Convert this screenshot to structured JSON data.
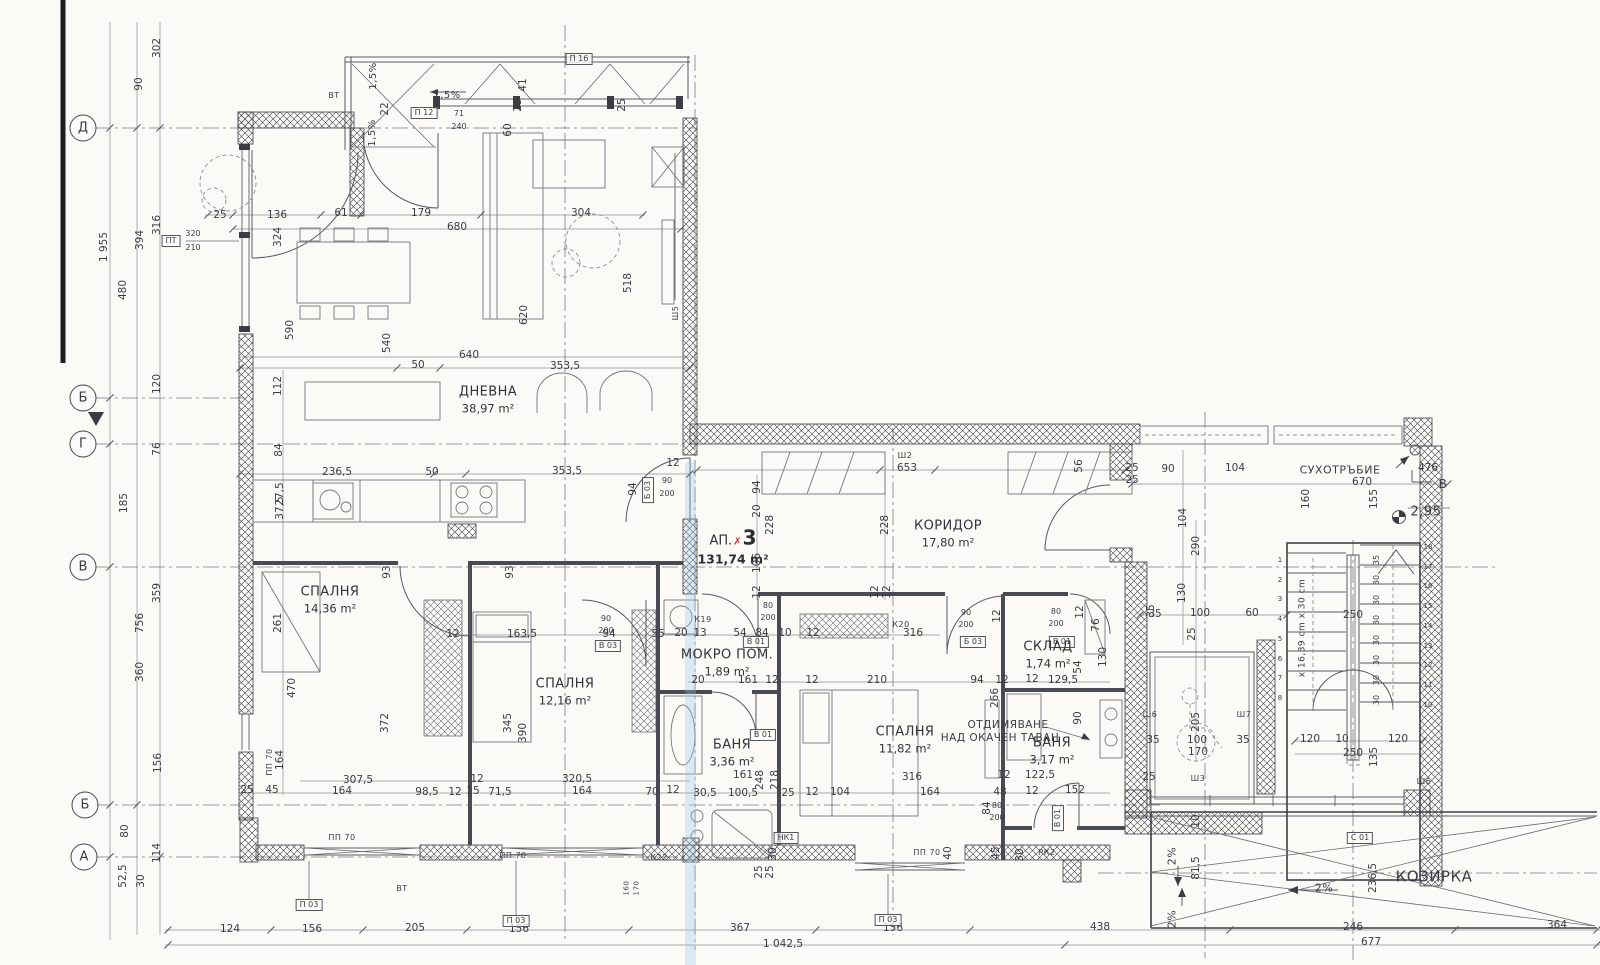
{
  "plan": {
    "apartment_label": "АП.",
    "apartment_mark": "✗",
    "apartment_number": "3",
    "apartment_area": "131,74 m²"
  },
  "rooms": [
    {
      "n": "ДНЕВНА",
      "a": "38,97 m²",
      "x": 488,
      "y": 400
    },
    {
      "n": "КОРИДОР",
      "a": "17,80 m²",
      "x": 948,
      "y": 534
    },
    {
      "n": "СПАЛНЯ",
      "a": "14,36 m²",
      "x": 330,
      "y": 600
    },
    {
      "n": "СПАЛНЯ",
      "a": "12,16 m²",
      "x": 565,
      "y": 692
    },
    {
      "n": "СПАЛНЯ",
      "a": "11,82 m²",
      "x": 905,
      "y": 740
    },
    {
      "n": "МОКРО ПОМ.",
      "a": "1,89 m²",
      "x": 727,
      "y": 663
    },
    {
      "n": "БАНЯ",
      "a": "3,36 m²",
      "x": 732,
      "y": 753
    },
    {
      "n": "БАНЯ",
      "a": "3,17 m²",
      "x": 1052,
      "y": 751
    },
    {
      "n": "СКЛАД",
      "a": "1,74 m²",
      "x": 1048,
      "y": 655
    }
  ],
  "grid_markers": [
    {
      "l": "Д",
      "x": 83,
      "y": 128
    },
    {
      "l": "Б",
      "x": 83,
      "y": 398
    },
    {
      "l": "Г",
      "x": 83,
      "y": 444
    },
    {
      "l": "В",
      "x": 83,
      "y": 567
    },
    {
      "l": "Б",
      "x": 85,
      "y": 805
    },
    {
      "l": "А",
      "x": 84,
      "y": 857
    }
  ],
  "annotations": [
    {
      "t": "СУХОТРЪБИЕ",
      "x": 1340,
      "y": 470,
      "s": 11
    },
    {
      "t": "ОТДИМЯВАНЕ",
      "x": 1008,
      "y": 725,
      "s": 10.5
    },
    {
      "t": "НАД ОКАЧЕН ТАВАН",
      "x": 1000,
      "y": 738,
      "s": 10.5
    },
    {
      "t": "КОЗИРКА",
      "x": 1434,
      "y": 877,
      "s": 15
    },
    {
      "t": "2,95",
      "x": 1426,
      "y": 512,
      "s": 13
    },
    {
      "t": "В",
      "x": 1443,
      "y": 484,
      "s": 12
    },
    {
      "t": "1,5%",
      "x": 447,
      "y": 96,
      "s": 10
    },
    {
      "t": "1,5%",
      "x": 374,
      "y": 76,
      "s": 10,
      "r": 1
    },
    {
      "t": "1,5%",
      "x": 373,
      "y": 133,
      "s": 10,
      "r": 1
    },
    {
      "t": "2%",
      "x": 1324,
      "y": 888,
      "s": 11
    },
    {
      "t": "2%",
      "x": 1172,
      "y": 856,
      "s": 11,
      "r": 1
    },
    {
      "t": "2%",
      "x": 1172,
      "y": 919,
      "s": 11,
      "r": 1
    },
    {
      "t": "ВТ",
      "x": 334,
      "y": 96,
      "s": 8
    },
    {
      "t": "ВТ",
      "x": 402,
      "y": 889,
      "s": 8
    },
    {
      "t": "РК2",
      "x": 1047,
      "y": 853,
      "s": 8
    },
    {
      "t": "К19",
      "x": 703,
      "y": 620,
      "s": 8
    },
    {
      "t": "К20",
      "x": 901,
      "y": 625,
      "s": 8
    },
    {
      "t": "К22",
      "x": 659,
      "y": 858,
      "s": 8
    },
    {
      "t": "Ш2",
      "x": 905,
      "y": 456,
      "s": 8
    },
    {
      "t": "Ш5",
      "x": 676,
      "y": 313,
      "s": 8,
      "r": 1
    },
    {
      "t": "Ш6",
      "x": 1150,
      "y": 715,
      "s": 8
    },
    {
      "t": "Ш7",
      "x": 1244,
      "y": 715,
      "s": 8
    },
    {
      "t": "Ш3",
      "x": 1198,
      "y": 779,
      "s": 8
    },
    {
      "t": "Ш6",
      "x": 1424,
      "y": 782,
      "s": 8
    },
    {
      "t": "ПП 70",
      "x": 342,
      "y": 838,
      "s": 8
    },
    {
      "t": "ПП 70",
      "x": 513,
      "y": 856,
      "s": 8
    },
    {
      "t": "ПП 70",
      "x": 927,
      "y": 853,
      "s": 8
    },
    {
      "t": "ПП 70",
      "x": 270,
      "y": 762,
      "s": 8,
      "r": 1
    },
    {
      "t": "х 16,39 cm х 30 cm",
      "x": 1303,
      "y": 628,
      "s": 9,
      "r": 1
    },
    {
      "t": "160",
      "x": 627,
      "y": 888,
      "s": 7,
      "r": 1
    },
    {
      "t": "170",
      "x": 637,
      "y": 888,
      "s": 7,
      "r": 1
    }
  ],
  "tags": [
    {
      "t": "П 16",
      "x": 579,
      "y": 59
    },
    {
      "t": "П 12",
      "x": 424,
      "y": 113
    },
    {
      "t": "ПТ",
      "x": 171,
      "y": 241
    },
    {
      "t": "П 03",
      "x": 309,
      "y": 905
    },
    {
      "t": "П 03",
      "x": 516,
      "y": 921
    },
    {
      "t": "П 03",
      "x": 888,
      "y": 920
    },
    {
      "t": "С 01",
      "x": 1360,
      "y": 838
    },
    {
      "t": "В 03",
      "x": 608,
      "y": 646
    },
    {
      "t": "В 01",
      "x": 756,
      "y": 642
    },
    {
      "t": "Б 03",
      "x": 973,
      "y": 642
    },
    {
      "t": "В 01",
      "x": 1062,
      "y": 642
    },
    {
      "t": "В 01",
      "x": 763,
      "y": 735
    },
    {
      "t": "В 01",
      "x": 1058,
      "y": 818,
      "r": 1
    },
    {
      "t": "Б 03",
      "x": 648,
      "y": 490,
      "r": 1
    },
    {
      "t": "НК1",
      "x": 786,
      "y": 838
    }
  ],
  "dimensions": [
    [
      "302",
      157,
      48,
      1
    ],
    [
      "90",
      139,
      84,
      1
    ],
    [
      "1 955",
      104,
      247,
      1
    ],
    [
      "394",
      140,
      240,
      1
    ],
    [
      "316",
      157,
      225,
      1
    ],
    [
      "480",
      123,
      290,
      1
    ],
    [
      "120",
      157,
      384,
      1
    ],
    [
      "76",
      157,
      449,
      1
    ],
    [
      "185",
      124,
      503,
      1
    ],
    [
      "359",
      157,
      593,
      1
    ],
    [
      "756",
      140,
      623,
      1
    ],
    [
      "360",
      140,
      672,
      1
    ],
    [
      "156",
      158,
      763,
      1
    ],
    [
      "80",
      125,
      831,
      1
    ],
    [
      "114",
      157,
      853,
      1
    ],
    [
      "52,5",
      123,
      876,
      1
    ],
    [
      "30",
      141,
      881,
      1
    ],
    [
      "112",
      278,
      386,
      1
    ],
    [
      "84",
      279,
      450,
      1
    ],
    [
      "27,5",
      280,
      494,
      1
    ],
    [
      "37,5",
      280,
      508,
      1
    ],
    [
      "261",
      278,
      623,
      1
    ],
    [
      "164",
      280,
      760,
      1
    ],
    [
      "470",
      292,
      688,
      1
    ],
    [
      "372",
      385,
      723,
      1
    ],
    [
      "345",
      508,
      723,
      1
    ],
    [
      "390",
      523,
      733,
      1
    ],
    [
      "25",
      220,
      215
    ],
    [
      "136",
      277,
      215
    ],
    [
      "61",
      341,
      213
    ],
    [
      "179",
      421,
      213
    ],
    [
      "304",
      581,
      213
    ],
    [
      "680",
      457,
      227
    ],
    [
      "324",
      278,
      237,
      1
    ],
    [
      "590",
      290,
      330,
      1
    ],
    [
      "540",
      387,
      343,
      1
    ],
    [
      "518",
      628,
      283,
      1
    ],
    [
      "620",
      524,
      315,
      1
    ],
    [
      "41",
      523,
      85,
      1
    ],
    [
      "25",
      518,
      105,
      1
    ],
    [
      "22",
      385,
      109,
      1
    ],
    [
      "60",
      508,
      130,
      1
    ],
    [
      "25",
      622,
      105,
      1
    ],
    [
      "71",
      459,
      114,
      0,
      1
    ],
    [
      "240",
      459,
      127,
      0,
      1
    ],
    [
      "320",
      193,
      234,
      0,
      1
    ],
    [
      "210",
      193,
      248,
      0,
      1
    ],
    [
      "640",
      469,
      355
    ],
    [
      "50",
      418,
      365
    ],
    [
      "353,5",
      565,
      366
    ],
    [
      "236,5",
      337,
      472
    ],
    [
      "50",
      432,
      472
    ],
    [
      "353,5",
      567,
      471
    ],
    [
      "12",
      673,
      463
    ],
    [
      "94",
      633,
      489,
      1
    ],
    [
      "90",
      667,
      481,
      0,
      1
    ],
    [
      "200",
      667,
      494,
      0,
      1
    ],
    [
      "93",
      387,
      572,
      1
    ],
    [
      "93",
      510,
      572,
      1
    ],
    [
      "12",
      453,
      634
    ],
    [
      "163,5",
      522,
      634
    ],
    [
      "94",
      609,
      634
    ],
    [
      "55",
      658,
      634
    ],
    [
      "20",
      681,
      633
    ],
    [
      "13",
      700,
      633
    ],
    [
      "54",
      740,
      633
    ],
    [
      "84",
      762,
      633
    ],
    [
      "10",
      785,
      633
    ],
    [
      "12",
      813,
      633
    ],
    [
      "316",
      913,
      633
    ],
    [
      "90",
      606,
      619,
      0,
      1
    ],
    [
      "200",
      606,
      631,
      0,
      1
    ],
    [
      "94",
      757,
      487,
      1
    ],
    [
      "20",
      757,
      511,
      1
    ],
    [
      "228",
      770,
      525,
      1
    ],
    [
      "106",
      757,
      563,
      1
    ],
    [
      "12",
      757,
      592,
      1
    ],
    [
      "228",
      885,
      525,
      1
    ],
    [
      "12",
      875,
      592,
      1
    ],
    [
      "12",
      887,
      592,
      1
    ],
    [
      "653",
      907,
      468
    ],
    [
      "56",
      1079,
      466,
      1
    ],
    [
      "25",
      1132,
      468
    ],
    [
      "25",
      1132,
      480
    ],
    [
      "90",
      1168,
      469
    ],
    [
      "104",
      1235,
      468
    ],
    [
      "670",
      1362,
      482
    ],
    [
      "476",
      1428,
      468
    ],
    [
      "160",
      1306,
      499,
      1
    ],
    [
      "155",
      1374,
      499,
      1
    ],
    [
      "20",
      698,
      680
    ],
    [
      "161",
      748,
      680
    ],
    [
      "12",
      772,
      680
    ],
    [
      "12",
      812,
      680
    ],
    [
      "210",
      877,
      680
    ],
    [
      "94",
      977,
      680
    ],
    [
      "12",
      1002,
      680
    ],
    [
      "12",
      1032,
      679
    ],
    [
      "129,5",
      1063,
      680
    ],
    [
      "54",
      1078,
      667,
      1
    ],
    [
      "266",
      995,
      698,
      1
    ],
    [
      "76",
      1096,
      625,
      1
    ],
    [
      "130",
      1103,
      657,
      1
    ],
    [
      "12",
      997,
      616,
      1
    ],
    [
      "12",
      1080,
      612,
      1
    ],
    [
      "80",
      1056,
      612,
      0,
      1
    ],
    [
      "200",
      1056,
      624,
      0,
      1
    ],
    [
      "90",
      966,
      613,
      0,
      1
    ],
    [
      "200",
      966,
      625,
      0,
      1
    ],
    [
      "80",
      768,
      606,
      0,
      1
    ],
    [
      "200",
      768,
      618,
      0,
      1
    ],
    [
      "307,5",
      358,
      780
    ],
    [
      "320,5",
      577,
      779
    ],
    [
      "12",
      477,
      779
    ],
    [
      "25",
      247,
      790
    ],
    [
      "45",
      272,
      790
    ],
    [
      "164",
      342,
      791
    ],
    [
      "98,5",
      427,
      792
    ],
    [
      "12",
      455,
      792
    ],
    [
      "15",
      473,
      791
    ],
    [
      "71,5",
      500,
      792
    ],
    [
      "164",
      582,
      791
    ],
    [
      "70",
      652,
      792
    ],
    [
      "12",
      673,
      790
    ],
    [
      "161",
      743,
      775
    ],
    [
      "248",
      760,
      780,
      1
    ],
    [
      "218",
      775,
      780,
      1
    ],
    [
      "30,5",
      705,
      793
    ],
    [
      "100,5",
      743,
      793
    ],
    [
      "25",
      788,
      793
    ],
    [
      "12",
      812,
      792
    ],
    [
      "104",
      840,
      792
    ],
    [
      "164",
      930,
      792
    ],
    [
      "48",
      1000,
      792
    ],
    [
      "12",
      1032,
      791
    ],
    [
      "152",
      1075,
      790
    ],
    [
      "316",
      912,
      777
    ],
    [
      "122,5",
      1040,
      775
    ],
    [
      "12",
      1004,
      775
    ],
    [
      "30",
      773,
      854,
      1
    ],
    [
      "25",
      759,
      872,
      1
    ],
    [
      "25",
      770,
      872,
      1
    ],
    [
      "40",
      948,
      853,
      1
    ],
    [
      "45",
      996,
      853,
      1
    ],
    [
      "30",
      1020,
      855,
      1
    ],
    [
      "84",
      987,
      808,
      1
    ],
    [
      "90",
      1078,
      718,
      1
    ],
    [
      "80",
      997,
      806,
      0,
      1
    ],
    [
      "200",
      997,
      818,
      0,
      1
    ],
    [
      "104",
      1183,
      518,
      1
    ],
    [
      "290",
      1196,
      546,
      1
    ],
    [
      "130",
      1182,
      593,
      1
    ],
    [
      "35",
      1155,
      614
    ],
    [
      "100",
      1200,
      613
    ],
    [
      "60",
      1252,
      613
    ],
    [
      "25",
      1192,
      634,
      1
    ],
    [
      "250",
      1353,
      615
    ],
    [
      "35",
      1151,
      611,
      1
    ],
    [
      "205",
      1196,
      722,
      1
    ],
    [
      "100",
      1197,
      740
    ],
    [
      "170",
      1198,
      752
    ],
    [
      "35",
      1153,
      740
    ],
    [
      "35",
      1243,
      740
    ],
    [
      "25",
      1149,
      777
    ],
    [
      "120",
      1310,
      739
    ],
    [
      "10",
      1342,
      739
    ],
    [
      "120",
      1398,
      739
    ],
    [
      "250",
      1353,
      753
    ],
    [
      "135",
      1374,
      757,
      1
    ],
    [
      "81,5",
      1196,
      868,
      1
    ],
    [
      "10",
      1196,
      821,
      1
    ],
    [
      "236,5",
      1373,
      878,
      1
    ],
    [
      "438",
      1100,
      927
    ],
    [
      "246",
      1353,
      927
    ],
    [
      "364",
      1557,
      925
    ],
    [
      "677",
      1371,
      942
    ],
    [
      "124",
      230,
      929
    ],
    [
      "156",
      312,
      929
    ],
    [
      "205",
      415,
      928
    ],
    [
      "156",
      519,
      929
    ],
    [
      "367",
      740,
      928
    ],
    [
      "156",
      893,
      928
    ],
    [
      "1 042,5",
      783,
      944
    ]
  ],
  "stairs": {
    "left_numbers": [
      "1",
      "2",
      "3",
      "4",
      "5",
      "6",
      "7",
      "8"
    ],
    "left_x": 1280,
    "left_y0": 560,
    "left_dy": 19.7,
    "right_numbers": [
      "18",
      "17",
      "16",
      "15",
      "14",
      "13",
      "12",
      "11",
      "10"
    ],
    "right_x": 1428,
    "right_y0": 547,
    "right_dy": 19.7,
    "riser_labels": [
      "35",
      "30",
      "30",
      "30",
      "30",
      "30",
      "30",
      "30"
    ],
    "riser_x": 1377,
    "riser_y0": 560,
    "riser_dy": 20
  },
  "ticks": [
    [
      168,
      930
    ],
    [
      271,
      930
    ],
    [
      363,
      930
    ],
    [
      467,
      930
    ],
    [
      629,
      930
    ],
    [
      816,
      930
    ],
    [
      970,
      930
    ],
    [
      1230,
      930
    ],
    [
      1455,
      930
    ],
    [
      1597,
      930
    ],
    [
      168,
      945
    ],
    [
      1065,
      945
    ],
    [
      1597,
      945
    ],
    [
      208,
      215
    ],
    [
      233,
      215
    ],
    [
      321,
      215
    ],
    [
      361,
      215
    ],
    [
      481,
      215
    ],
    [
      643,
      215
    ],
    [
      233,
      229
    ],
    [
      681,
      229
    ],
    [
      240,
      368
    ],
    [
      397,
      368
    ],
    [
      440,
      368
    ],
    [
      690,
      368
    ],
    [
      240,
      474
    ],
    [
      434,
      474
    ],
    [
      466,
      474
    ],
    [
      690,
      474
    ],
    [
      110,
      128
    ],
    [
      110,
      398
    ],
    [
      110,
      444
    ],
    [
      110,
      567
    ],
    [
      110,
      805
    ],
    [
      110,
      857
    ],
    [
      137,
      128
    ],
    [
      137,
      805
    ],
    [
      160,
      128
    ],
    [
      160,
      857
    ],
    [
      697,
      470
    ],
    [
      880,
      470
    ],
    [
      935,
      470
    ],
    [
      1125,
      470
    ],
    [
      1132,
      484
    ],
    [
      1448,
      484
    ],
    [
      1140,
      615
    ],
    [
      1287,
      615
    ],
    [
      1295,
      741
    ],
    [
      1423,
      741
    ]
  ],
  "colors": {
    "ink": "#3c3c45",
    "red_mark": "#c23434",
    "paper": "#fbfaf7",
    "blue_streak": "#96c3eb"
  }
}
